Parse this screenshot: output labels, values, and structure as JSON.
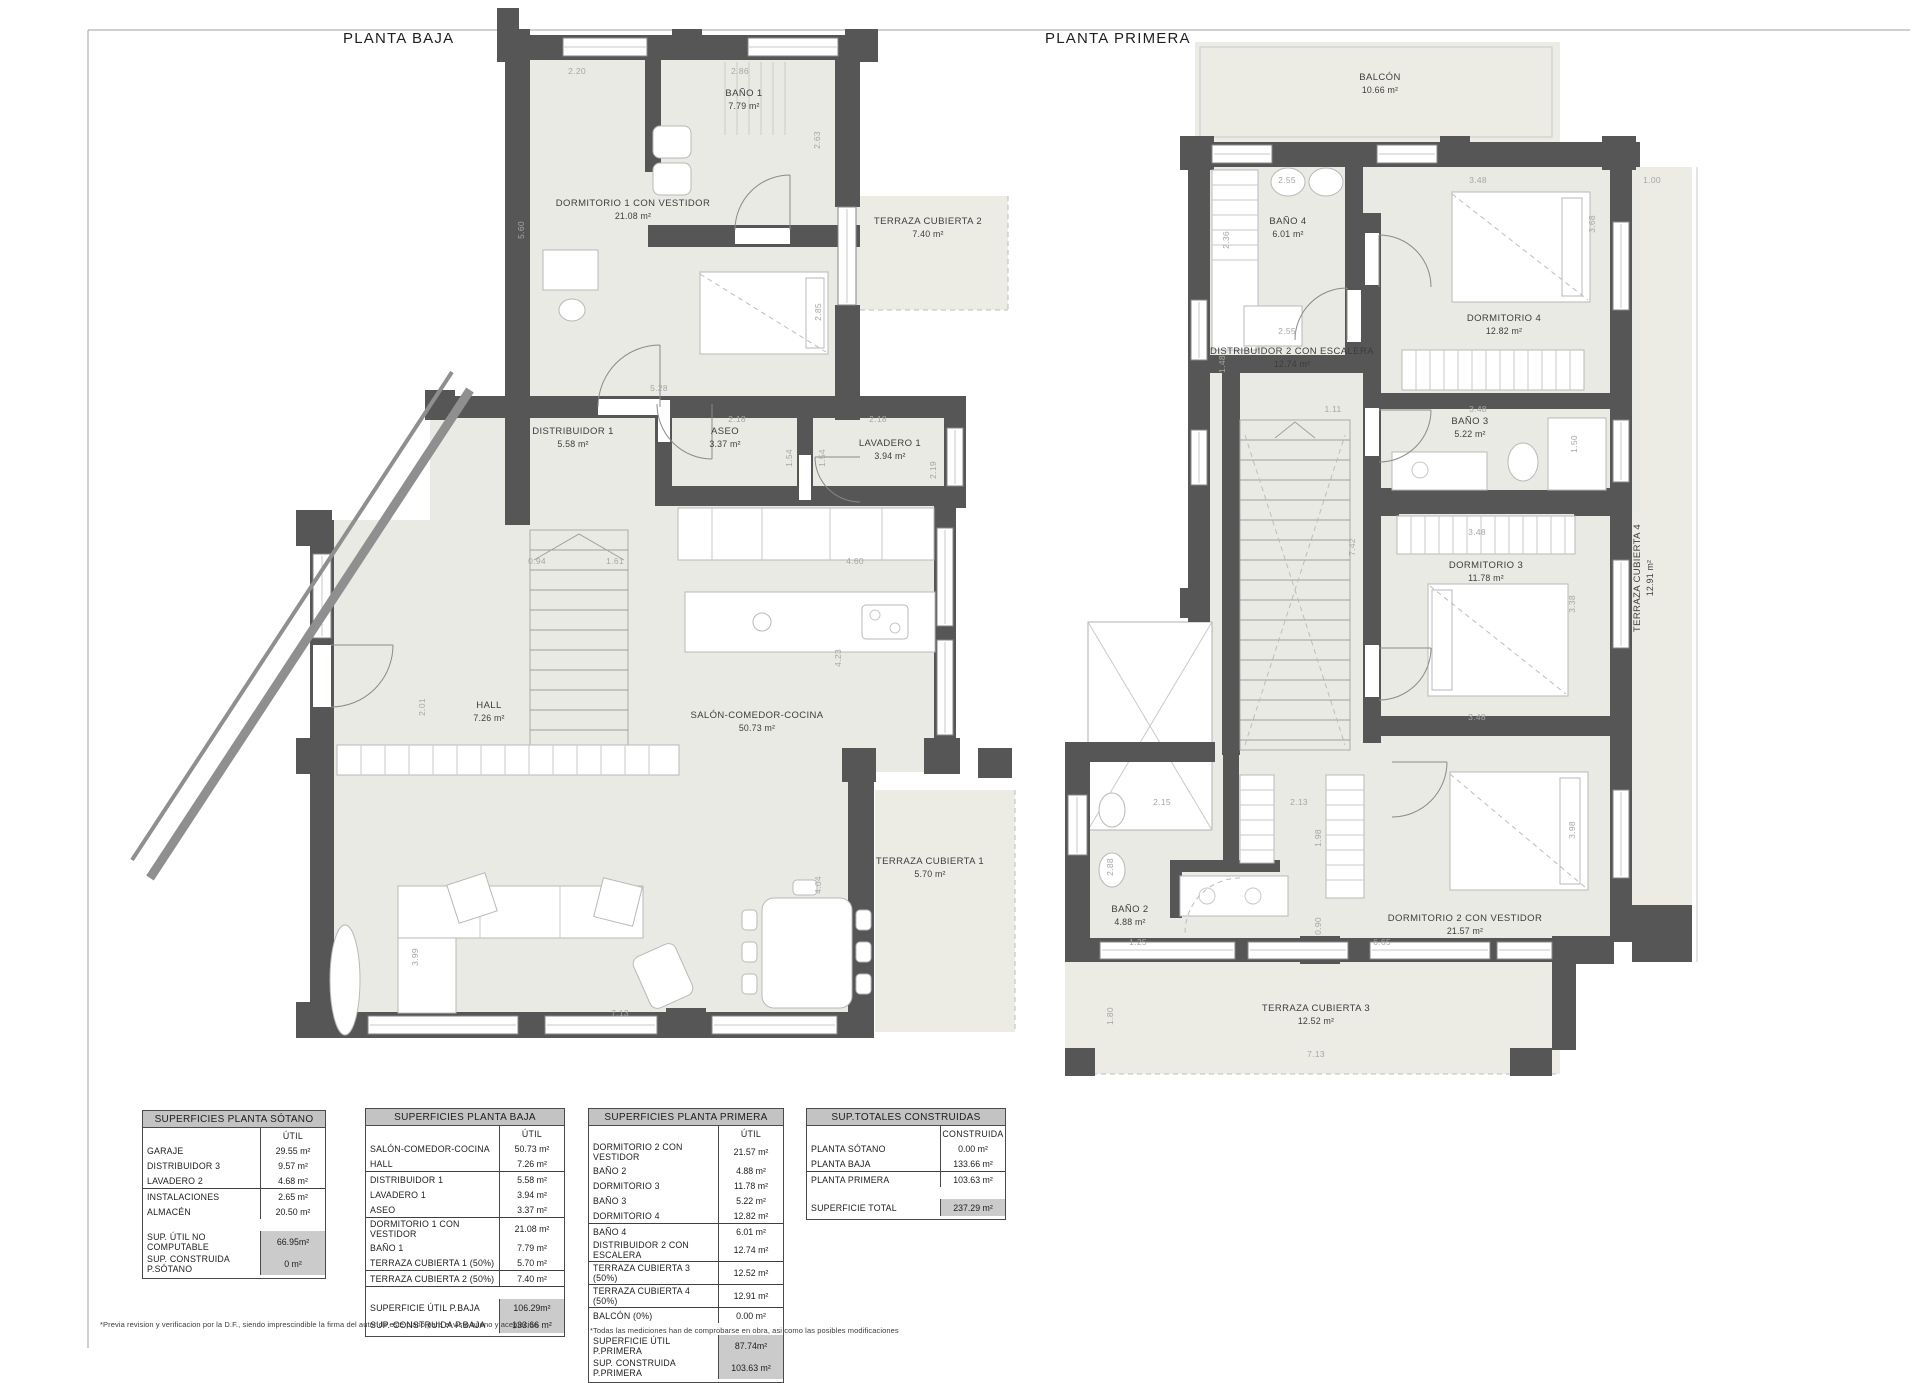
{
  "colors": {
    "wall": "#565656",
    "floor": "#eaeae4",
    "terrace": "#ecece5",
    "dim_text": "#a6a6a6",
    "label_text": "#3d3d3d",
    "furniture": "#b8b8b8",
    "table_border": "#4a4a4a",
    "table_header_bg": "#c3c3c3",
    "table_total_bg": "#cbcbcb"
  },
  "titles": {
    "baja": "PLANTA BAJA",
    "primera": "PLANTA PRIMERA"
  },
  "footnotes": {
    "left": "*Previa revision y verificacion por la D.F., siendo imprescindible la firma del autor de este plano para el visto bueno y aceptación",
    "right": "*Todas las mediciones han de comprobarse en obra, asi como las posibles modificaciones"
  },
  "plans": {
    "baja": {
      "rooms": [
        {
          "name": "BAÑO 1",
          "area": "7.79 m²",
          "x": 744,
          "y": 100
        },
        {
          "name": "DORMITORIO 1 CON VESTIDOR",
          "area": "21.08 m²",
          "x": 633,
          "y": 210
        },
        {
          "name": "TERRAZA CUBIERTA 2",
          "area": "7.40 m²",
          "x": 928,
          "y": 228
        },
        {
          "name": "DISTRIBUIDOR 1",
          "area": "5.58 m²",
          "x": 573,
          "y": 438
        },
        {
          "name": "ASEO",
          "area": "3.37 m²",
          "x": 725,
          "y": 438
        },
        {
          "name": "LAVADERO 1",
          "area": "3.94 m²",
          "x": 890,
          "y": 450
        },
        {
          "name": "HALL",
          "area": "7.26 m²",
          "x": 489,
          "y": 712
        },
        {
          "name": "SALÓN-COMEDOR-COCINA",
          "area": "50.73 m²",
          "x": 757,
          "y": 722
        },
        {
          "name": "TERRAZA CUBIERTA 1",
          "area": "5.70 m²",
          "x": 930,
          "y": 868
        }
      ],
      "dims": [
        {
          "t": "2.20",
          "x": 577,
          "y": 71
        },
        {
          "t": "2.86",
          "x": 740,
          "y": 71
        },
        {
          "t": "5.60",
          "x": 521,
          "y": 230,
          "r": 1
        },
        {
          "t": "2.63",
          "x": 817,
          "y": 140,
          "r": 1
        },
        {
          "t": "2.85",
          "x": 818,
          "y": 312,
          "r": 1
        },
        {
          "t": "5.28",
          "x": 659,
          "y": 388
        },
        {
          "t": "2.18",
          "x": 737,
          "y": 419
        },
        {
          "t": "1.54",
          "x": 789,
          "y": 458,
          "r": 1
        },
        {
          "t": "2.18",
          "x": 878,
          "y": 419
        },
        {
          "t": "1.54",
          "x": 822,
          "y": 458,
          "r": 1
        },
        {
          "t": "2.19",
          "x": 933,
          "y": 470,
          "r": 1
        },
        {
          "t": "0.94",
          "x": 537,
          "y": 561
        },
        {
          "t": "1.61",
          "x": 615,
          "y": 561
        },
        {
          "t": "4.60",
          "x": 855,
          "y": 561
        },
        {
          "t": "4.23",
          "x": 838,
          "y": 658,
          "r": 1
        },
        {
          "t": "2.01",
          "x": 422,
          "y": 707,
          "r": 1
        },
        {
          "t": "3.99",
          "x": 415,
          "y": 957,
          "r": 1
        },
        {
          "t": "4.04",
          "x": 818,
          "y": 885,
          "r": 1
        },
        {
          "t": "7.13",
          "x": 620,
          "y": 1013
        }
      ]
    },
    "primera": {
      "rooms": [
        {
          "name": "BALCÓN",
          "area": "10.66 m²",
          "x": 1380,
          "y": 84
        },
        {
          "name": "BAÑO 4",
          "area": "6.01 m²",
          "x": 1288,
          "y": 228
        },
        {
          "name": "DORMITORIO 4",
          "area": "12.82 m²",
          "x": 1504,
          "y": 325
        },
        {
          "name": "DISTRIBUIDOR 2 CON ESCALERA",
          "area": "12.74 m²",
          "x": 1292,
          "y": 358
        },
        {
          "name": "BAÑO 3",
          "area": "5.22 m²",
          "x": 1470,
          "y": 428
        },
        {
          "name": "DORMITORIO 3",
          "area": "11.78 m²",
          "x": 1486,
          "y": 572
        },
        {
          "name": "TERRAZA CUBIERTA 4",
          "area": "12.91 m²",
          "x": 1644,
          "y": 578,
          "r": 1
        },
        {
          "name": "BAÑO 2",
          "area": "4.88 m²",
          "x": 1130,
          "y": 916
        },
        {
          "name": "DORMITORIO 2 CON VESTIDOR",
          "area": "21.57 m²",
          "x": 1465,
          "y": 925
        },
        {
          "name": "TERRAZA CUBIERTA 3",
          "area": "12.52 m²",
          "x": 1316,
          "y": 1015
        }
      ],
      "dims": [
        {
          "t": "2.55",
          "x": 1287,
          "y": 180
        },
        {
          "t": "3.48",
          "x": 1478,
          "y": 180
        },
        {
          "t": "1.00",
          "x": 1652,
          "y": 180
        },
        {
          "t": "2.36",
          "x": 1226,
          "y": 240,
          "r": 1
        },
        {
          "t": "3.68",
          "x": 1592,
          "y": 224,
          "r": 1
        },
        {
          "t": "2.55",
          "x": 1287,
          "y": 331
        },
        {
          "t": "1.48",
          "x": 1222,
          "y": 364,
          "r": 1
        },
        {
          "t": "1.11",
          "x": 1333,
          "y": 409
        },
        {
          "t": "3.48",
          "x": 1478,
          "y": 409
        },
        {
          "t": "1.50",
          "x": 1574,
          "y": 444,
          "r": 1
        },
        {
          "t": "7.42",
          "x": 1352,
          "y": 547,
          "r": 1
        },
        {
          "t": "3.48",
          "x": 1477,
          "y": 532
        },
        {
          "t": "3.38",
          "x": 1572,
          "y": 604,
          "r": 1
        },
        {
          "t": "3.48",
          "x": 1477,
          "y": 717
        },
        {
          "t": "2.15",
          "x": 1162,
          "y": 802
        },
        {
          "t": "2.13",
          "x": 1299,
          "y": 802
        },
        {
          "t": "1.98",
          "x": 1318,
          "y": 838,
          "r": 1
        },
        {
          "t": "2.88",
          "x": 1110,
          "y": 867,
          "r": 1
        },
        {
          "t": "0.90",
          "x": 1318,
          "y": 926,
          "r": 1
        },
        {
          "t": "6.65",
          "x": 1382,
          "y": 942
        },
        {
          "t": "1.25",
          "x": 1138,
          "y": 942
        },
        {
          "t": "3.98",
          "x": 1572,
          "y": 830,
          "r": 1
        },
        {
          "t": "1.80",
          "x": 1110,
          "y": 1016,
          "r": 1
        },
        {
          "t": "7.13",
          "x": 1316,
          "y": 1054
        }
      ]
    }
  },
  "tables": [
    {
      "title": "SUPERFICIES PLANTA SÓTANO",
      "col_header": "ÚTIL",
      "x": 142,
      "y": 1110,
      "w": 184,
      "rows": [
        {
          "label": "GARAJE",
          "value": "29.55 m²"
        },
        {
          "label": "DISTRIBUIDOR 3",
          "value": "9.57 m²"
        },
        {
          "label": "LAVADERO 2",
          "value": "4.68 m²",
          "rule": true
        },
        {
          "label": "INSTALACIONES",
          "value": "2.65 m²"
        },
        {
          "label": "ALMACÉN",
          "value": "20.50 m²"
        }
      ],
      "totals": [
        {
          "label": "SUP. ÚTIL NO COMPUTABLE",
          "value": "66.95m²"
        },
        {
          "label": "SUP. CONSTRUIDA P.SÓTANO",
          "value": "0 m²"
        }
      ]
    },
    {
      "title": "SUPERFICIES PLANTA BAJA",
      "col_header": "ÚTIL",
      "x": 365,
      "y": 1108,
      "w": 200,
      "rows": [
        {
          "label": "SALÓN-COMEDOR-COCINA",
          "value": "50.73 m²"
        },
        {
          "label": "HALL",
          "value": "7.26 m²",
          "rule": true
        },
        {
          "label": "DISTRIBUIDOR 1",
          "value": "5.58 m²"
        },
        {
          "label": "LAVADERO 1",
          "value": "3.94 m²"
        },
        {
          "label": "ASEO",
          "value": "3.37 m²",
          "rule": true
        },
        {
          "label": "DORMITORIO 1 CON VESTIDOR",
          "value": "21.08 m²"
        },
        {
          "label": "BAÑO 1",
          "value": "7.79 m²"
        },
        {
          "label": "TERRAZA CUBIERTA 1 (50%)",
          "value": "5.70 m²",
          "rule": true
        },
        {
          "label": "TERRAZA CUBIERTA 2 (50%)",
          "value": "7.40 m²",
          "rule": true
        }
      ],
      "totals": [
        {
          "label": "SUPERFICIE ÚTIL P.BAJA",
          "value": "106.29m²"
        },
        {
          "label": "SUP. CONSTRUIDA P.BAJA",
          "value": "133.66 m²"
        }
      ]
    },
    {
      "title": "SUPERFICIES PLANTA PRIMERA",
      "col_header": "ÚTIL",
      "x": 588,
      "y": 1108,
      "w": 196,
      "rows": [
        {
          "label": "DORMITORIO 2 CON VESTIDOR",
          "value": "21.57 m²"
        },
        {
          "label": "BAÑO 2",
          "value": "4.88 m²"
        },
        {
          "label": "DORMITORIO 3",
          "value": "11.78 m²"
        },
        {
          "label": "BAÑO 3",
          "value": "5.22 m²"
        },
        {
          "label": "DORMITORIO 4",
          "value": "12.82 m²",
          "rule": true
        },
        {
          "label": "BAÑO 4",
          "value": "6.01 m²"
        },
        {
          "label": "DISTRIBUIDOR 2 CON ESCALERA",
          "value": "12.74 m²",
          "rule": true
        },
        {
          "label": "TERRAZA CUBIERTA 3 (50%)",
          "value": "12.52 m²",
          "rule": true
        },
        {
          "label": "TERRAZA CUBIERTA 4 (50%)",
          "value": "12.91 m²",
          "rule": true
        },
        {
          "label": "BALCÓN (0%)",
          "value": "0.00 m²"
        }
      ],
      "totals": [
        {
          "label": "SUPERFICIE ÚTIL P.PRIMERA",
          "value": "87.74m²"
        },
        {
          "label": "SUP. CONSTRUIDA P.PRIMERA",
          "value": "103.63 m²"
        }
      ]
    },
    {
      "title": "SUP.TOTALES CONSTRUIDAS",
      "col_header": "CONSTRUIDA",
      "x": 806,
      "y": 1108,
      "w": 200,
      "rows": [
        {
          "label": "PLANTA SÓTANO",
          "value": "0.00 m²"
        },
        {
          "label": "PLANTA BAJA",
          "value": "133.66 m²",
          "rule": true
        },
        {
          "label": "PLANTA PRIMERA",
          "value": "103.63 m²"
        }
      ],
      "totals": [
        {
          "label": "SUPERFICIE TOTAL",
          "value": "237.29 m²"
        }
      ]
    }
  ]
}
